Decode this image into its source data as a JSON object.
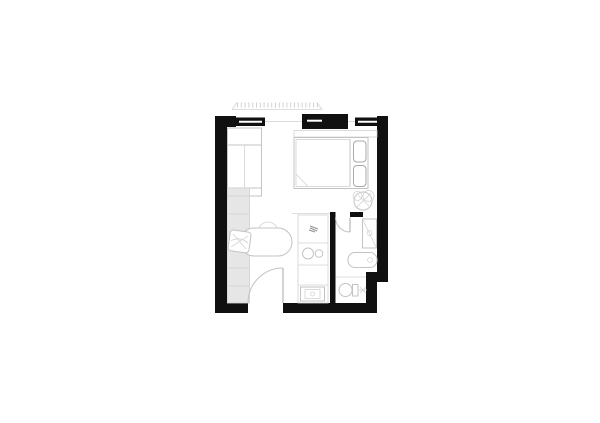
{
  "document": {
    "type": "architectural-floor-plan",
    "description": "Black and white floor plan drawing of a studio apartment with bedroom zone, kitchenette, bathroom, WC and entry door, centered on a blank white page"
  },
  "colors": {
    "background": "#ffffff",
    "wall": "#101010",
    "line": "#c3c3c3",
    "line-strong": "#a9a9a9",
    "counter-fill": "#e6e6e6",
    "grid": "#d2d2d2",
    "glyph": "#8f8f8f"
  },
  "elements": {
    "canopy": "louver-canopy-overhead",
    "walls": [
      "left-wall",
      "top-wall",
      "right-wall",
      "bottom-wall",
      "stepped-corner",
      "bathroom-partition"
    ],
    "windows": [
      "window-top-left",
      "window-top-center-pier",
      "window-top-right"
    ],
    "doors": [
      "entry-door-swing",
      "bathroom-door-swing"
    ],
    "furniture": [
      "wardrobe",
      "counter-grid",
      "desk-chair",
      "oval-table",
      "round-stool",
      "kitchenette",
      "kitchen-sink",
      "faucet",
      "washing-machine",
      "double-bed",
      "pillow",
      "pillow",
      "headboard-shelf",
      "potted-plant"
    ],
    "bathroom_fixtures": [
      "shower",
      "bathtub",
      "toilet",
      "toilet-accessory"
    ]
  }
}
